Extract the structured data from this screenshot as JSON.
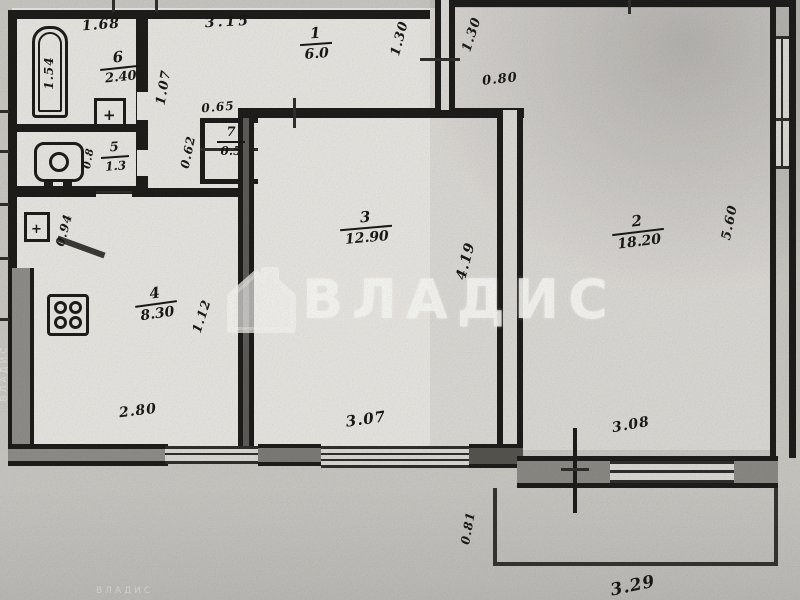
{
  "watermark": {
    "brand": "ВЛАДИС",
    "small_text": "ВЛАДИС"
  },
  "rooms": {
    "r1": {
      "number": "1",
      "area": "6.0"
    },
    "r2": {
      "number": "2",
      "area": "18.20"
    },
    "r3": {
      "number": "3",
      "area": "12.90"
    },
    "r4": {
      "number": "4",
      "area": "8.30"
    },
    "r5": {
      "number": "5",
      "area": "1.3"
    },
    "r6": {
      "number": "6",
      "area": "2.40"
    },
    "r7": {
      "number": "7",
      "area": "0.5"
    }
  },
  "dims": {
    "bath_width": "1.68",
    "tub_length": "1.54",
    "hall_top": "3.15",
    "hall_height_left": "1.30",
    "hall_height_right": "1.30",
    "room2_door": "0.80",
    "corridor_width": "1.07",
    "closet_width": "0.65",
    "closet_side": "0.62",
    "wc_side": "0.8",
    "sink_side": "0.94",
    "kitchen_side": "1.12",
    "room3_depth": "4.19",
    "room2_depth": "5.60",
    "kitchen_width": "2.80",
    "room3_width": "3.07",
    "room2_width": "3.08",
    "balcony_depth": "0.81",
    "balcony_width": "3.29"
  }
}
